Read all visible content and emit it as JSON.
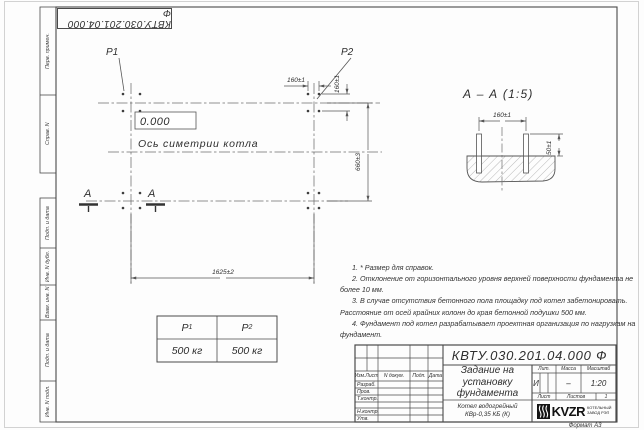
{
  "sheet": {
    "stamp_code": "КВТУ.030.201.04.000 Ф",
    "format_label": "Формат А3",
    "margin": {
      "perv_primen": "Перв. примен.",
      "sprav_n": "Справ. N",
      "podp_data_1": "Подп. и дата",
      "inv_n_dubl": "Инв. N дубл.",
      "vzam_inv_n": "Взам. инв. N",
      "podp_data_2": "Подп. и дата",
      "inv_n_podl": "Инв. N подл."
    }
  },
  "plan": {
    "label_p1": "P1",
    "label_p2": "P2",
    "elevation": "0.000",
    "axis_label": "Ось симетрии котла",
    "dim_bolt_h": "160±1",
    "dim_bolt_v": "160±1",
    "dim_width": "660±3",
    "dim_length": "1625±2",
    "section_letter_left": "А",
    "section_letter_right": "А"
  },
  "section": {
    "title": "А – А (1:5)",
    "dim_spacing": "160±1",
    "dim_height": "50±1"
  },
  "loads": {
    "p_symbol": "P",
    "p1_index": "1",
    "p2_index": "2",
    "p1_value": "500 кг",
    "p2_value": "500 кг"
  },
  "notes": [
    "1. * Размер для справок.",
    "2. Отклонение от горизонтального уровня верхней поверхности фундамента не более 10 мм.",
    "3. В случае отсутствия бетонного пола площадку под котел забетонировать. Расстояние от осей крайних колонн до края бетонной подушки 500 мм.",
    "4. Фундамент под котел разрабатывает проектная организация по нагрузкам на фундамент."
  ],
  "title_block": {
    "designation": "КВТУ.030.201.04.000 Ф",
    "doc_title": "Задание на установку фундамента",
    "product_line1": "Котел водогрейный",
    "product_line2": "КВр-0,35 КБ (К)",
    "header": {
      "izm": "Изм.Лист",
      "ndoc": "N докум.",
      "podp": "Подп.",
      "data": "Дата"
    },
    "rows": {
      "razrab": "Разраб.",
      "prov": "Пров.",
      "tkontr": "Т.контр.",
      "nkontr": "Н.контр.",
      "utv": "Утв."
    },
    "lit_header": {
      "lit": "Лит.",
      "massa": "Масса",
      "masshtab": "Масштаб"
    },
    "lit_values": {
      "lit": "И",
      "massa": "–",
      "masshtab": "1:20"
    },
    "sheet_row": {
      "list": "Лист",
      "listov": "Листов",
      "listov_val": "1"
    },
    "logo": {
      "name": "KVZR",
      "line1": "КОТЕЛЬНЫЙ",
      "line2": "ЗАВОД РЭП"
    }
  }
}
